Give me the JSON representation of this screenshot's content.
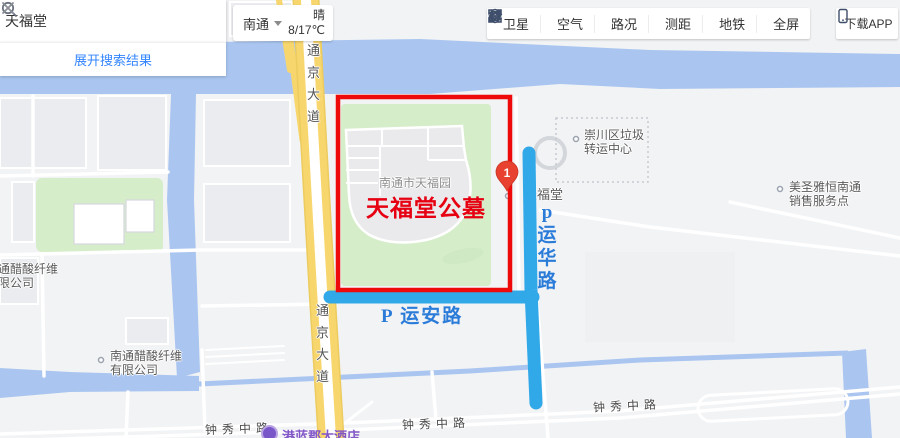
{
  "search": {
    "query": "天福堂",
    "expand_label": "展开搜索结果"
  },
  "city_selector": {
    "city": "南通"
  },
  "weather": {
    "condition": "晴",
    "temperature": "8/17℃"
  },
  "toolbar": {
    "items": [
      {
        "label": "卫星"
      },
      {
        "label": "空气"
      },
      {
        "label": "路况"
      },
      {
        "label": "测距"
      },
      {
        "label": "地铁"
      },
      {
        "label": "全屏"
      }
    ],
    "download_label": "下载APP"
  },
  "annotations": {
    "cemetery_title": "天福堂公墓",
    "road_yunan": "P 运安路",
    "road_yunhua": "p运华路",
    "colors": {
      "red": "#ee0a0a",
      "road_blue": "#31a8e8",
      "label_blue": "#2b7cd9"
    }
  },
  "marker": {
    "number": "1"
  },
  "map_labels": {
    "park": "南通市天福园",
    "poi_tianfutang": "天福堂",
    "garbage_center": {
      "line1": "崇川区垃圾",
      "line2": "转运中心"
    },
    "sales_point": {
      "line1": "美圣雅恒南通",
      "line2": "销售服务点"
    },
    "cellulose_left": {
      "line1": "南通醋酸纤维",
      "line2": "有限公司"
    },
    "cellulose": {
      "line1": "南通醋酸纤维",
      "line2": "有限公司"
    },
    "road_tongjing": "通京大道",
    "road_zhongxiu": "钟秀中路",
    "hotel": "港蓝郡大酒店"
  },
  "map_colors": {
    "water": "#aac6f0",
    "green": "#d6edca",
    "road_yellow": "#f8d66e",
    "background": "#f2f3f5"
  }
}
